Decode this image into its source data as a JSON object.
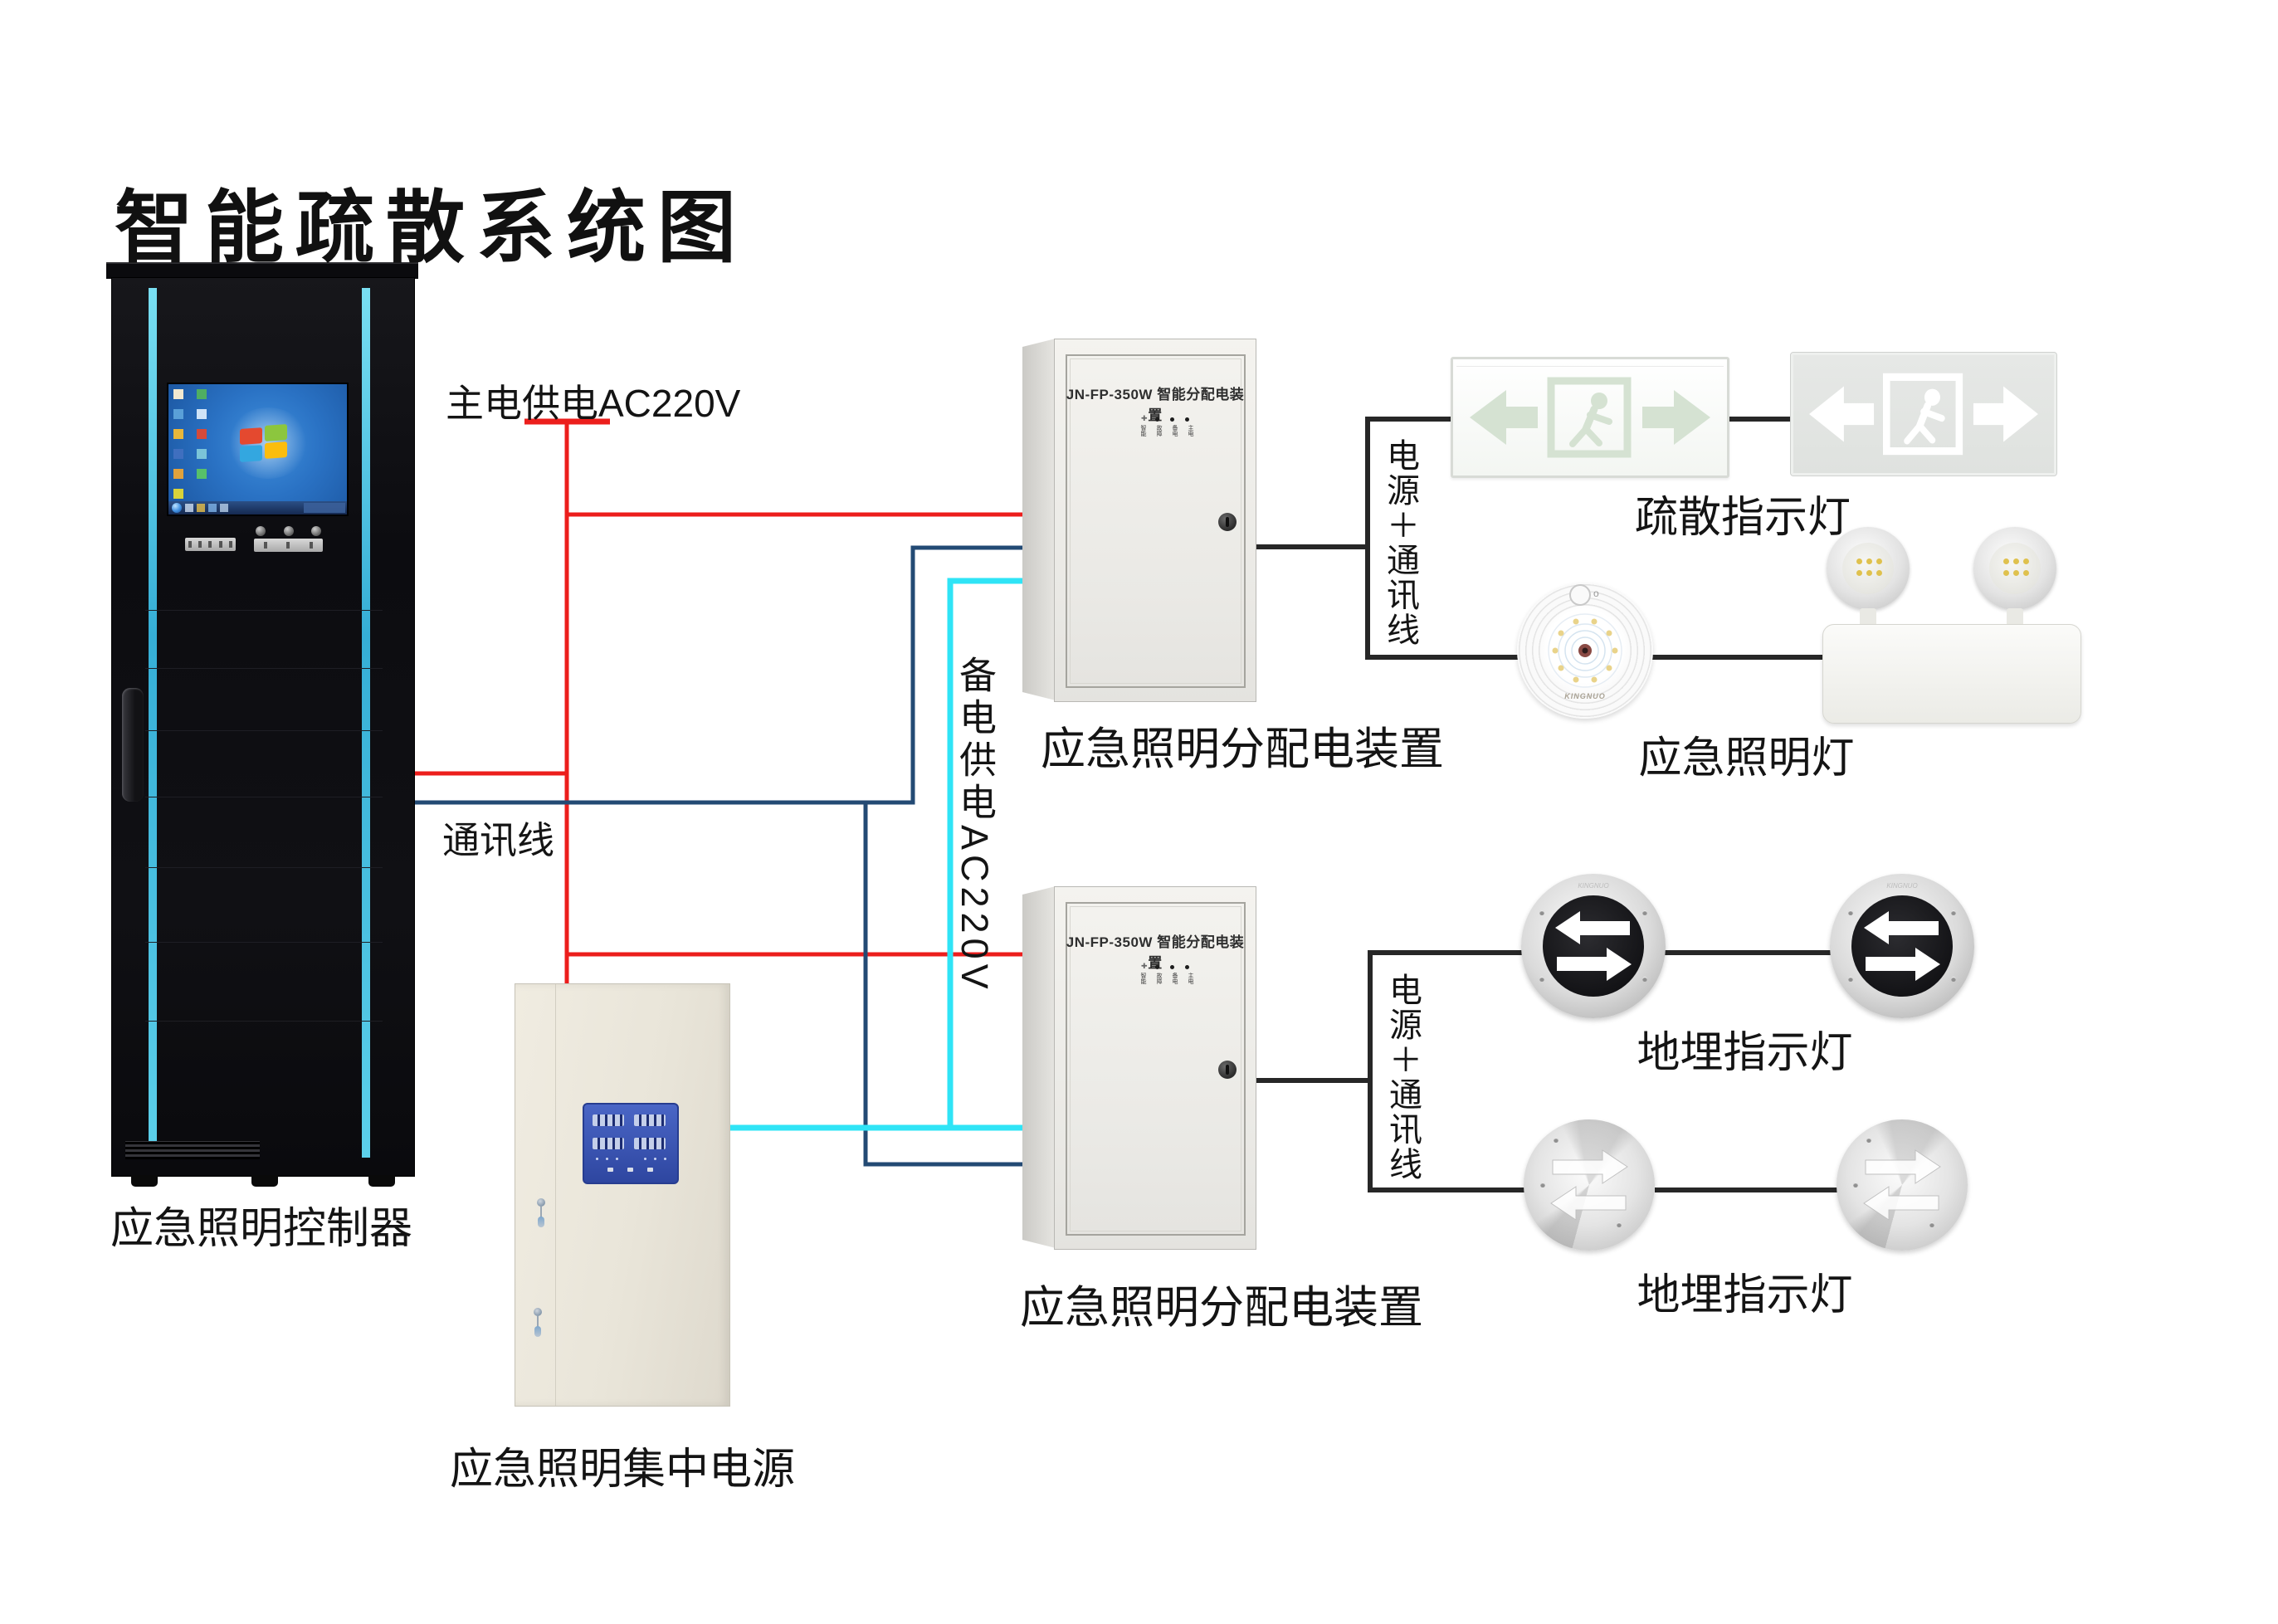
{
  "title": "智能疏散系统图",
  "colors": {
    "main_power_wire": "#ec1e1c",
    "comm_wire": "#234a74",
    "backup_power_wire": "#2fe4f6",
    "device_link_wire": "#272727",
    "rack_accent": "#49c8e8",
    "panel_blue": "#3a55b5"
  },
  "brand": "KINGNUO",
  "wire_labels": {
    "main_power": "主电供电AC220V",
    "comm": "通讯线",
    "backup_power": "备电供电AC220V",
    "power_comm_1": "电源＋通讯线",
    "power_comm_2": "电源＋通讯线"
  },
  "devices": {
    "controller": {
      "label": "应急照明控制器"
    },
    "central_power": {
      "label": "应急照明集中电源"
    },
    "dist_box_1": {
      "panel_title": "JN-FP-350W 智能分配电装置",
      "label": "应急照明分配电装置",
      "led_labels": [
        "智能",
        "故障",
        "备电",
        "主电"
      ]
    },
    "dist_box_2": {
      "panel_title": "JN-FP-350W 智能分配电装置",
      "label": "应急照明分配电装置",
      "led_labels": [
        "智能",
        "故障",
        "备电",
        "主电"
      ]
    },
    "exit_signs": {
      "label": "疏散指示灯"
    },
    "emergency_lights": {
      "label": "应急照明灯",
      "button_mark": "o"
    },
    "ground_lights_row1": {
      "label": "地埋指示灯"
    },
    "ground_lights_row2": {
      "label": "地埋指示灯"
    }
  }
}
